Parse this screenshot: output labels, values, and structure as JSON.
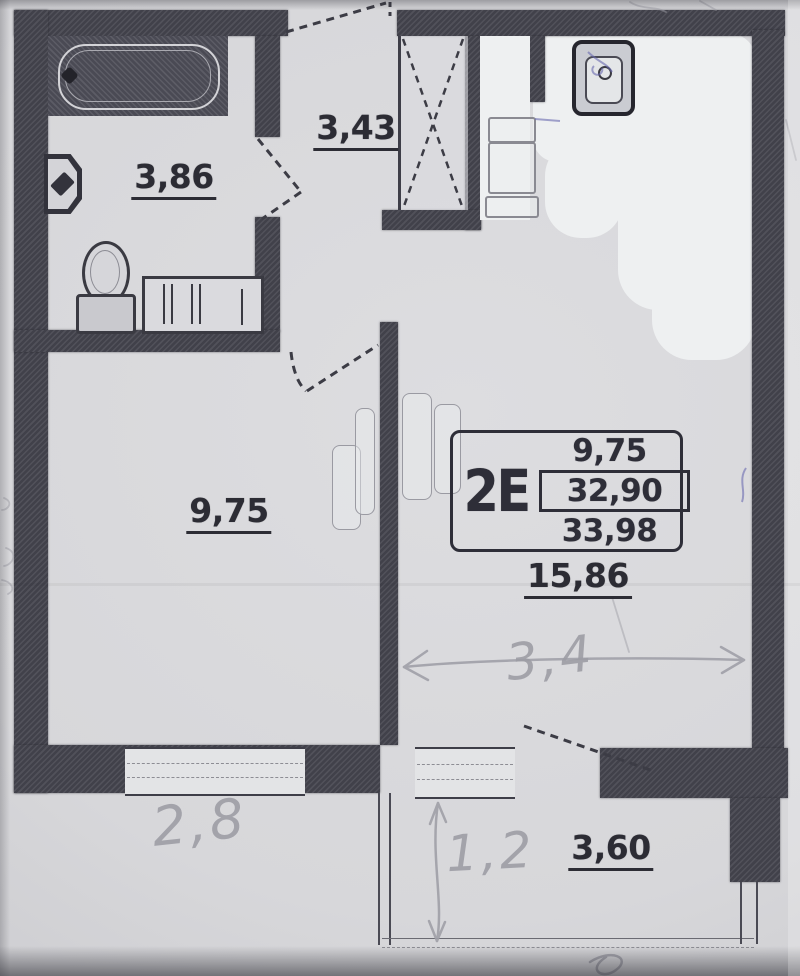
{
  "document": {
    "kind": "scanned apartment floor plan",
    "orientation": "portrait"
  },
  "unit": {
    "code": "2E",
    "living_area": "9,75",
    "area_no_balcony": "32,90",
    "total_area": "33,98"
  },
  "rooms": {
    "bathroom": {
      "area": "3,86"
    },
    "hallway": {
      "area": "3,43"
    },
    "room": {
      "area": "9,75"
    },
    "kitchen_living": {
      "area": "15,86"
    },
    "balcony": {
      "area": "3,60"
    }
  },
  "handwritten": {
    "room_width": "2,8",
    "living_width": "3,4",
    "balcony_depth": "1,2"
  },
  "fixtures": [
    "bathtub",
    "wash-basin",
    "toilet",
    "washing-machine",
    "built-in-closet",
    "stove-cabinet",
    "kitchen-sink",
    "wardrobe-panels"
  ],
  "colors": {
    "wall": "#41414a",
    "paper": "#d7d7da",
    "whiteout": "#eef0f1",
    "ink": "#2c2c34",
    "pencil": "#9c9ca4",
    "blue_pen": "#6a6ab0"
  }
}
